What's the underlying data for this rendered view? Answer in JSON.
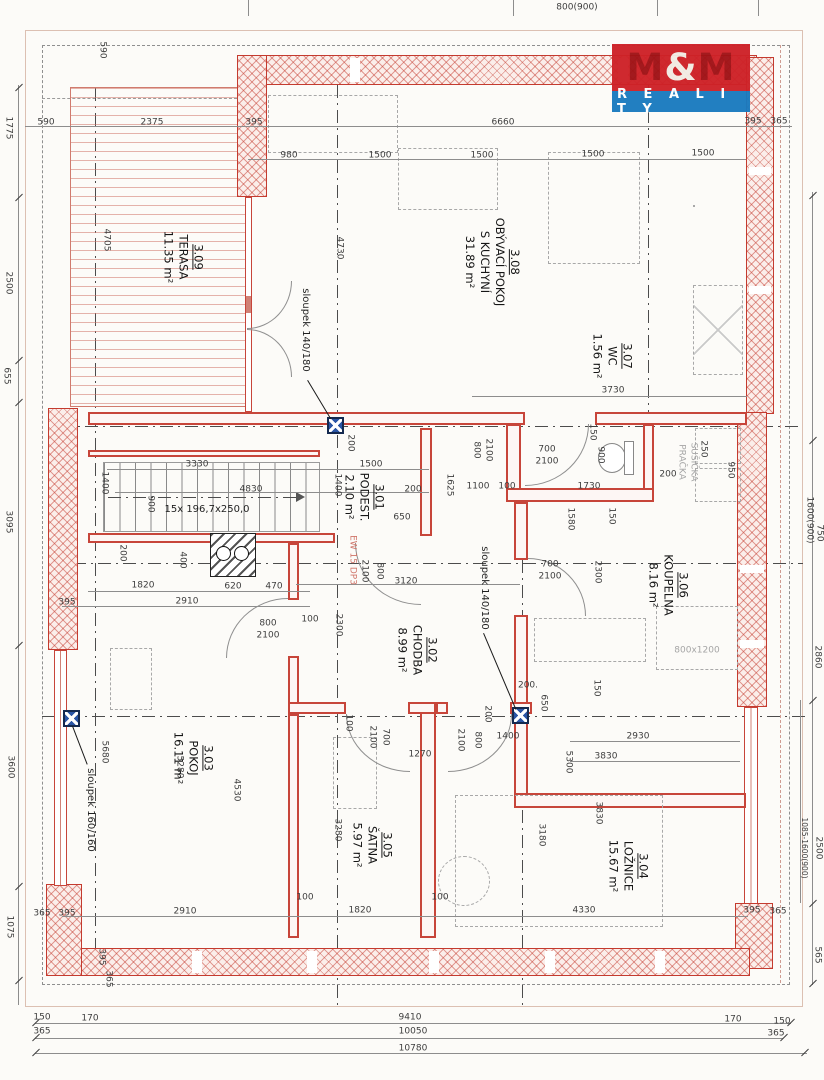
{
  "logo": {
    "m1": "M",
    "amp": "&",
    "m2": "M",
    "reality": "R E A L I T Y"
  },
  "rooms": [
    {
      "id": "3.09",
      "name": "TERASA",
      "area": "11.35 m²",
      "x": 183,
      "y": 257
    },
    {
      "id": "3.08",
      "name": "OBÝVACÍ POKOJ",
      "name2": "S KUCHYNÍ",
      "area": "31.89 m²",
      "x": 492,
      "y": 262
    },
    {
      "id": "3.07",
      "name": "WC",
      "area": "1.56 m²",
      "x": 612,
      "y": 356
    },
    {
      "id": "3.01",
      "name": "PODEST.",
      "area": "2.10 m²",
      "x": 364,
      "y": 497
    },
    {
      "id": "3.06",
      "name": "KOUPELNA",
      "area": "8.16 m²",
      "x": 668,
      "y": 585
    },
    {
      "id": "3.02",
      "name": "CHODBA",
      "area": "8.99 m²",
      "x": 417,
      "y": 650
    },
    {
      "id": "3.03",
      "name": "POKOJ",
      "area": "16.11 m²",
      "x": 193,
      "y": 758
    },
    {
      "id": "3.05",
      "name": "ŠATNA",
      "area": "5.97 m²",
      "x": 372,
      "y": 845
    },
    {
      "id": "3.04",
      "name": "LOŽNICE",
      "area": "15.67 m²",
      "x": 628,
      "y": 866
    }
  ],
  "dims": [
    {
      "t": "800(900)",
      "x": 577,
      "y": 8
    },
    {
      "t": "590",
      "x": 46,
      "y": 123
    },
    {
      "t": "2375",
      "x": 152,
      "y": 123
    },
    {
      "t": "395",
      "x": 254,
      "y": 123
    },
    {
      "t": "6660",
      "x": 503,
      "y": 123
    },
    {
      "t": "395",
      "x": 753,
      "y": 122
    },
    {
      "t": "365",
      "x": 779,
      "y": 122
    },
    {
      "t": "980",
      "x": 289,
      "y": 156
    },
    {
      "t": "1500",
      "x": 380,
      "y": 156
    },
    {
      "t": "1500",
      "x": 482,
      "y": 156
    },
    {
      "t": "1500",
      "x": 593,
      "y": 155
    },
    {
      "t": "1500",
      "x": 703,
      "y": 154
    },
    {
      "t": "3730",
      "x": 613,
      "y": 391
    },
    {
      "t": "700",
      "x": 547,
      "y": 450
    },
    {
      "t": "2100",
      "x": 547,
      "y": 462
    },
    {
      "t": "1100",
      "x": 478,
      "y": 487
    },
    {
      "t": "100",
      "x": 507,
      "y": 487
    },
    {
      "t": "1730",
      "x": 589,
      "y": 487
    },
    {
      "t": "3330",
      "x": 197,
      "y": 465
    },
    {
      "t": "1500",
      "x": 371,
      "y": 465
    },
    {
      "t": "4830",
      "x": 251,
      "y": 490
    },
    {
      "t": "200",
      "x": 413,
      "y": 490
    },
    {
      "t": "650",
      "x": 402,
      "y": 518
    },
    {
      "t": "3120",
      "x": 406,
      "y": 582
    },
    {
      "t": "700",
      "x": 550,
      "y": 565
    },
    {
      "t": "2100",
      "x": 550,
      "y": 577
    },
    {
      "t": "200",
      "x": 668,
      "y": 475
    },
    {
      "t": "1820",
      "x": 143,
      "y": 586
    },
    {
      "t": "620",
      "x": 233,
      "y": 587
    },
    {
      "t": "470",
      "x": 274,
      "y": 587
    },
    {
      "t": "2910",
      "x": 187,
      "y": 602
    },
    {
      "t": "395",
      "x": 67,
      "y": 603
    },
    {
      "t": "800",
      "x": 268,
      "y": 624
    },
    {
      "t": "2100",
      "x": 268,
      "y": 636
    },
    {
      "t": "100",
      "x": 310,
      "y": 620
    },
    {
      "t": "1270",
      "x": 420,
      "y": 755
    },
    {
      "t": "1400",
      "x": 508,
      "y": 737
    },
    {
      "t": "200.",
      "x": 528,
      "y": 686
    },
    {
      "t": "2930",
      "x": 638,
      "y": 737
    },
    {
      "t": "3830",
      "x": 606,
      "y": 757
    },
    {
      "t": "800x1200",
      "x": 697,
      "y": 651,
      "c": "gray"
    },
    {
      "t": "2910",
      "x": 185,
      "y": 912
    },
    {
      "t": "100",
      "x": 305,
      "y": 898
    },
    {
      "t": "1820",
      "x": 360,
      "y": 911
    },
    {
      "t": "100",
      "x": 440,
      "y": 898
    },
    {
      "t": "4330",
      "x": 584,
      "y": 911
    },
    {
      "t": "395",
      "x": 752,
      "y": 911
    },
    {
      "t": "365",
      "x": 778,
      "y": 912
    },
    {
      "t": "365",
      "x": 42,
      "y": 914
    },
    {
      "t": "395",
      "x": 67,
      "y": 914
    },
    {
      "t": "150",
      "x": 42,
      "y": 1018
    },
    {
      "t": "170",
      "x": 90,
      "y": 1019
    },
    {
      "t": "9410",
      "x": 410,
      "y": 1018
    },
    {
      "t": "170",
      "x": 733,
      "y": 1020
    },
    {
      "t": "150",
      "x": 782,
      "y": 1022
    },
    {
      "t": "365",
      "x": 42,
      "y": 1032
    },
    {
      "t": "10050",
      "x": 413,
      "y": 1032
    },
    {
      "t": "365",
      "x": 776,
      "y": 1034
    },
    {
      "t": "10780",
      "x": 413,
      "y": 1049
    },
    {
      "t": "590",
      "x": 102,
      "y": 50,
      "r": 1
    },
    {
      "t": "1775",
      "x": 8,
      "y": 128,
      "r": 1
    },
    {
      "t": "2500",
      "x": 8,
      "y": 283,
      "r": 1
    },
    {
      "t": "655",
      "x": 6,
      "y": 376,
      "r": 1
    },
    {
      "t": "3095",
      "x": 8,
      "y": 522,
      "r": 1
    },
    {
      "t": "3600",
      "x": 10,
      "y": 767,
      "r": 1
    },
    {
      "t": "1075",
      "x": 9,
      "y": 927,
      "r": 1
    },
    {
      "t": "4705",
      "x": 106,
      "y": 240,
      "r": 1
    },
    {
      "t": "4730",
      "x": 339,
      "y": 248,
      "r": 1
    },
    {
      "t": "200",
      "x": 350,
      "y": 443,
      "r": 1
    },
    {
      "t": "1400",
      "x": 337,
      "y": 485,
      "r": 1
    },
    {
      "t": "1625",
      "x": 449,
      "y": 485,
      "r": 1
    },
    {
      "t": "1400",
      "x": 104,
      "y": 483,
      "r": 1
    },
    {
      "t": "900",
      "x": 150,
      "y": 504,
      "r": 1
    },
    {
      "t": "150",
      "x": 592,
      "y": 432,
      "r": 1
    },
    {
      "t": "900",
      "x": 600,
      "y": 455,
      "r": 1
    },
    {
      "t": "250",
      "x": 703,
      "y": 449,
      "r": 1
    },
    {
      "t": "950",
      "x": 730,
      "y": 470,
      "r": 1
    },
    {
      "t": "1580",
      "x": 570,
      "y": 519,
      "r": 1
    },
    {
      "t": "150",
      "x": 611,
      "y": 516,
      "r": 1
    },
    {
      "t": "2300",
      "x": 597,
      "y": 572,
      "r": 1
    },
    {
      "t": "2300",
      "x": 338,
      "y": 625,
      "r": 1
    },
    {
      "t": "2100",
      "x": 364,
      "y": 571,
      "r": 1
    },
    {
      "t": "800",
      "x": 379,
      "y": 571,
      "r": 1
    },
    {
      "t": "800",
      "x": 476,
      "y": 450,
      "r": 1
    },
    {
      "t": "2100",
      "x": 488,
      "y": 450,
      "r": 1
    },
    {
      "t": "200",
      "x": 122,
      "y": 553,
      "r": 1
    },
    {
      "t": "400",
      "x": 182,
      "y": 560,
      "r": 1
    },
    {
      "t": "100",
      "x": 348,
      "y": 723,
      "r": 1
    },
    {
      "t": "700",
      "x": 385,
      "y": 737,
      "r": 1
    },
    {
      "t": "2100",
      "x": 372,
      "y": 737,
      "r": 1
    },
    {
      "t": "200",
      "x": 487,
      "y": 714,
      "r": 1
    },
    {
      "t": "650",
      "x": 543,
      "y": 703,
      "r": 1
    },
    {
      "t": "2100",
      "x": 460,
      "y": 740,
      "r": 1
    },
    {
      "t": "800",
      "x": 477,
      "y": 740,
      "r": 1
    },
    {
      "t": "150",
      "x": 596,
      "y": 688,
      "r": 1
    },
    {
      "t": "5300",
      "x": 568,
      "y": 762,
      "r": 1
    },
    {
      "t": "5680",
      "x": 104,
      "y": 752,
      "r": 1
    },
    {
      "t": "5280",
      "x": 179,
      "y": 767,
      "r": 1
    },
    {
      "t": "4530",
      "x": 236,
      "y": 790,
      "r": 1
    },
    {
      "t": "3280",
      "x": 337,
      "y": 830,
      "r": 1
    },
    {
      "t": "3180",
      "x": 541,
      "y": 835,
      "r": 1
    },
    {
      "t": "3830",
      "x": 598,
      "y": 813,
      "r": 1
    },
    {
      "t": "1600(900)",
      "x": 809,
      "y": 520,
      "r": 1
    },
    {
      "t": "750",
      "x": 819,
      "y": 533,
      "r": 1
    },
    {
      "t": "2860",
      "x": 817,
      "y": 657,
      "r": 1
    },
    {
      "t": "1085-1600(900)",
      "x": 804,
      "y": 848,
      "r": 1,
      "c": "tiny"
    },
    {
      "t": "2500",
      "x": 818,
      "y": 848,
      "r": 1
    },
    {
      "t": "565",
      "x": 817,
      "y": 955,
      "r": 1
    },
    {
      "t": "395",
      "x": 101,
      "y": 957,
      "r": 1
    },
    {
      "t": "365",
      "x": 108,
      "y": 979,
      "r": 1
    },
    {
      "t": "15x 196,7x250,0",
      "x": 207,
      "y": 510,
      "c": "note"
    },
    {
      "t": "sloupek 140/180",
      "x": 305,
      "y": 330,
      "r": 1,
      "c": "note"
    },
    {
      "t": "sloupek 140/180",
      "x": 484,
      "y": 588,
      "r": 1,
      "c": "note"
    },
    {
      "t": "sloupek 160/160",
      "x": 90,
      "y": 810,
      "r": 1,
      "c": "note"
    },
    {
      "t": "EW 15 DP3",
      "x": 352,
      "y": 560,
      "r": 1,
      "c": "red"
    },
    {
      "t": "PRAČKA",
      "x": 681,
      "y": 462,
      "r": 1,
      "c": "gray"
    },
    {
      "t": "SUŠIČKA",
      "x": 693,
      "y": 462,
      "r": 1,
      "c": "gray"
    }
  ]
}
